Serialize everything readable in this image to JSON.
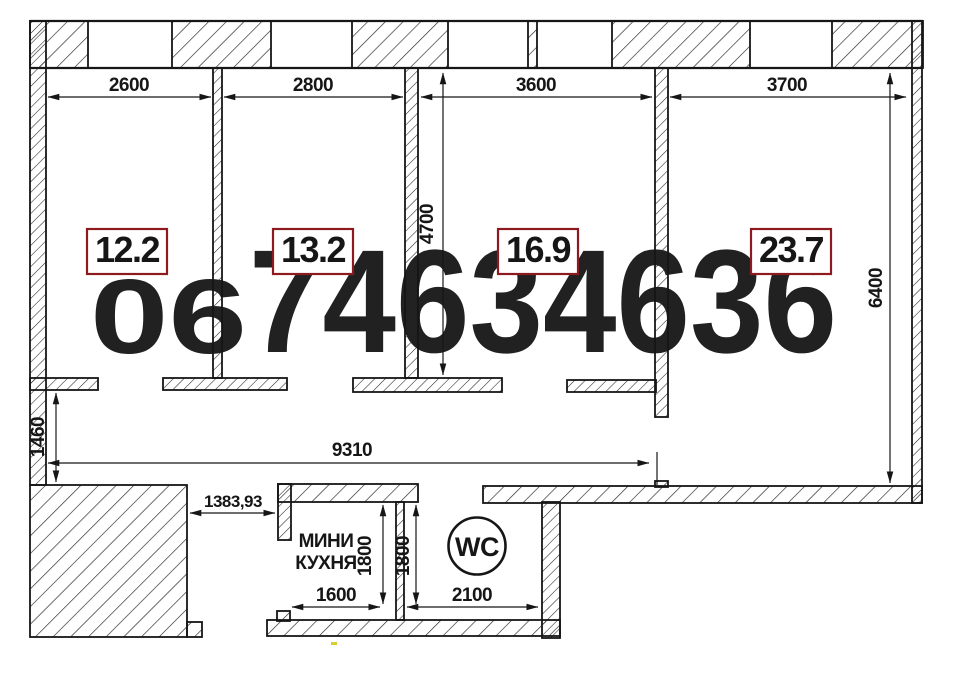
{
  "watermark": {
    "dark": "06",
    "light": "74634636"
  },
  "colors": {
    "accent": "#8d1a1f",
    "watermark_dark": "#c3cdec",
    "watermark_light": "#dde2f6",
    "ink": "#161616",
    "speck": "#d8ce32"
  },
  "rooms": [
    {
      "area": "12.2",
      "width": "2600"
    },
    {
      "area": "13.2",
      "width": "2800"
    },
    {
      "area": "16.9",
      "width": "3600",
      "depth": "4700"
    },
    {
      "area": "23.7",
      "width": "3700",
      "depth": "6400"
    }
  ],
  "hall": {
    "offset": "1460",
    "length": "9310",
    "gap": "1383,93"
  },
  "kitchen": {
    "name_line1": "МИНИ",
    "name_line2": "КУХНЯ",
    "width": "1600",
    "depth": "1800"
  },
  "wc": {
    "label": "WC",
    "width": "2100",
    "depth": "1800"
  }
}
